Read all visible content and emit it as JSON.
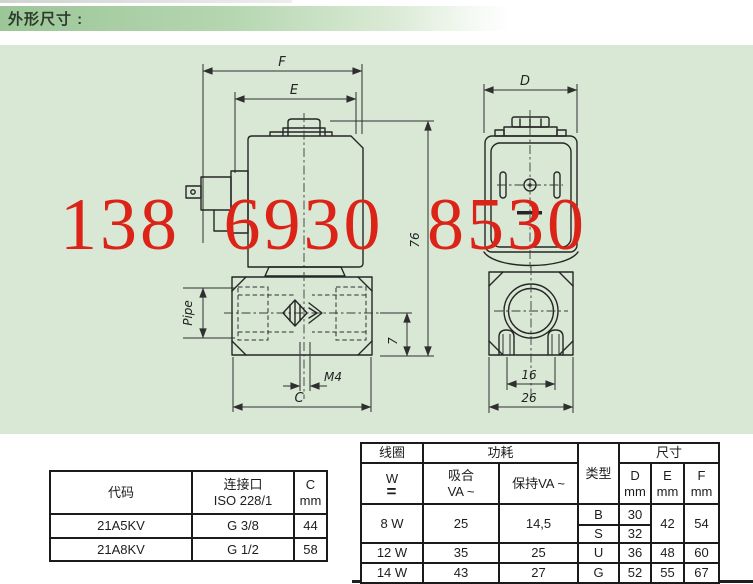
{
  "header": {
    "title": "外形尺寸 :"
  },
  "watermark": {
    "text": "138 6930 8530",
    "color": "#dc2318"
  },
  "drawing": {
    "side_view": {
      "dim_f": "F",
      "dim_e": "E",
      "height": "76",
      "pipe": "Pipe",
      "thread": "M4",
      "dim_c": "C",
      "offset": "7"
    },
    "front_view": {
      "dim_d": "D",
      "slot_width": "16",
      "body_width": "26"
    }
  },
  "code_table": {
    "col_code": "代码",
    "col_conn_l1": "连接口",
    "col_conn_l2": "ISO 228/1",
    "col_c_l1": "C",
    "col_c_l2": "mm",
    "rows": [
      {
        "code": "21A5KV",
        "conn": "G 3/8",
        "c": "44"
      },
      {
        "code": "21A8KV",
        "conn": "G 1/2",
        "c": "58"
      }
    ]
  },
  "spec_table": {
    "h_coil": "线圈",
    "h_power": "功耗",
    "h_type": "类型",
    "h_size": "尺寸",
    "h_w": "W",
    "h_dc": "=",
    "h_pull_l1": "吸合",
    "h_pull_l2": "VA ~",
    "h_hold": "保持VA ~",
    "h_d": "D",
    "h_e": "E",
    "h_f": "F",
    "h_mm": "mm",
    "row_8w": {
      "w": "8 W",
      "pull": "25",
      "hold": "14,5",
      "type_b": "B",
      "d_b": "30",
      "type_s": "S",
      "d_s": "32",
      "e": "42",
      "f": "54"
    },
    "row_12w": {
      "w": "12 W",
      "pull": "35",
      "hold": "25",
      "type": "U",
      "d": "36",
      "e": "48",
      "f": "60"
    },
    "row_14w": {
      "w": "14 W",
      "pull": "43",
      "hold": "27",
      "type": "G",
      "d": "52",
      "e": "55",
      "f": "67"
    }
  }
}
